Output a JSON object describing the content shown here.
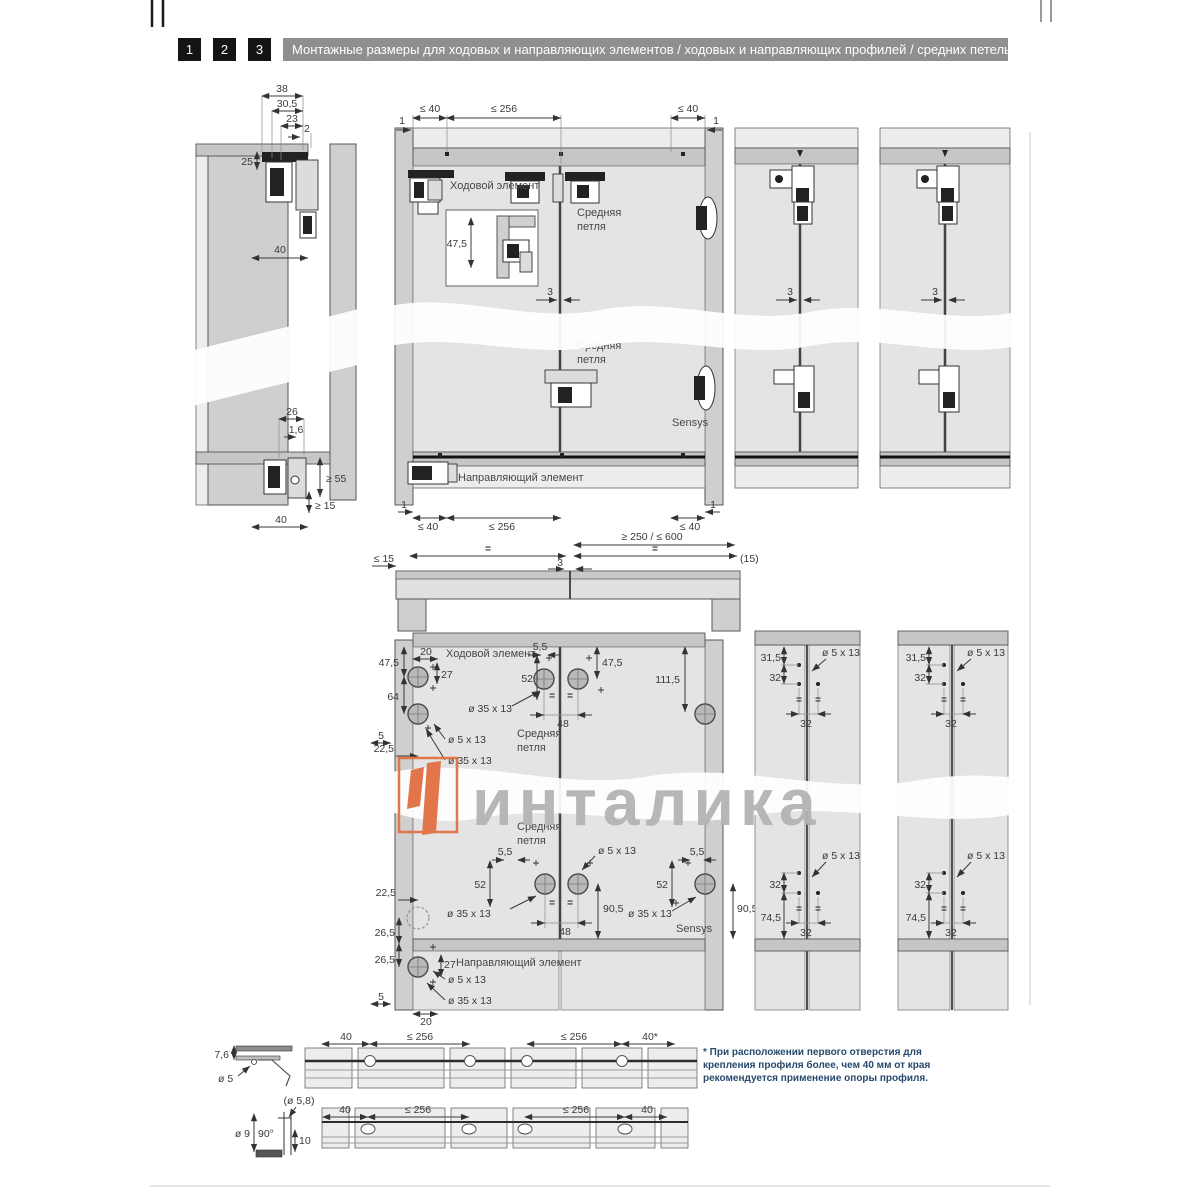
{
  "header": {
    "tabs": [
      "1",
      "2",
      "3"
    ],
    "title": "Монтажные размеры для ходовых и направляющих элементов / ходовых и направляющих профилей / средних петель"
  },
  "labels": {
    "running_element": "Ходовой элемент",
    "middle_hinge_l1": "Средняя",
    "middle_hinge_l2": "петля",
    "guide_element": "Направляющий элемент",
    "sensys": "Sensys"
  },
  "dims": {
    "v38": "38",
    "v30_5": "30,5",
    "v23": "23",
    "v2": "2",
    "v25": "25",
    "v40": "40",
    "v26": "26",
    "v1_6": "1,6",
    "ge55": "≥ 55",
    "ge15": "≥ 15",
    "le40": "≤ 40",
    "le256": "≤ 256",
    "v1": "1",
    "v3": "3",
    "range": "≥ 250 / ≤ 600",
    "le15": "≤ 15",
    "p15": "(15)",
    "eq": "=",
    "v47_5": "47,5",
    "v20": "20",
    "v27": "27",
    "v64": "64",
    "v5": "5",
    "v22_5": "22,5",
    "d5x13": "ø 5 x 13",
    "d35x13": "ø 35 x 13",
    "v5_5": "5,5",
    "v52": "52",
    "v48": "48",
    "v111_5": "111,5",
    "v90_5": "90,5",
    "v26_5": "26,5",
    "v31_5": "31,5",
    "v32": "32",
    "v74_5": "74,5",
    "v40s": "40*",
    "v7_6": "7,6",
    "d5": "ø 5",
    "d5_8": "(ø 5,8)",
    "d9": "ø 9",
    "a90": "90°",
    "v10": "10"
  },
  "watermark": {
    "text": "инталика"
  },
  "footnote": {
    "text": "* При расположении первого отверстия для крепления профиля более, чем 40 мм от края рекомендуется применение опоры профиля."
  },
  "colors": {
    "accent_orange": "#e2764a",
    "watermark_gray": "#b4b4b4",
    "footnote_blue": "#27496d",
    "header_bar_gray": "#8f8f8f",
    "tab_black": "#141414",
    "panel_light": "#e4e4e4",
    "panel_mid": "#cfcfcf",
    "rail_gray": "#c6c6c6"
  }
}
